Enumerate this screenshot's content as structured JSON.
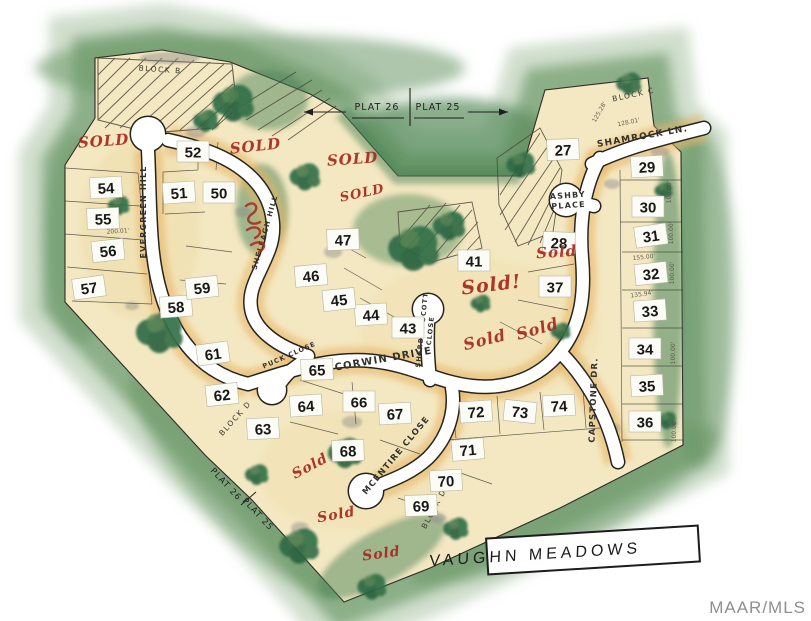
{
  "title_box": {
    "label": "VAUGHN  MEADOWS"
  },
  "watermark": "MAAR/MLS",
  "plat_notes": {
    "top_left": "PLAT 26",
    "top_right": "PLAT 25",
    "bottom_upper": "PLAT 26",
    "bottom_lower": "PLAT 25"
  },
  "blocks": [
    {
      "label": "BLOCK  B",
      "x": 160,
      "y": 72,
      "rotate": 4
    },
    {
      "label": "BLOCK  C",
      "x": 634,
      "y": 97,
      "rotate": -12
    },
    {
      "label": "BLOCK  D",
      "x": 237,
      "y": 420,
      "rotate": -48
    },
    {
      "label": "BLOCK  D",
      "x": 436,
      "y": 510,
      "rotate": -62
    }
  ],
  "streets": [
    {
      "name": "evergreen-hill",
      "lines": [
        "EVERGREEN  HILL"
      ],
      "x": 146,
      "y": 212,
      "rotate": -90,
      "size": 8
    },
    {
      "name": "sheleagh-hill",
      "lines": [
        "SHELEAGH  HILL"
      ],
      "x": 267,
      "y": 233,
      "rotate": -74,
      "size": 7
    },
    {
      "name": "shamrock-lane",
      "lines": [
        "SHAMROCK  LN."
      ],
      "x": 643,
      "y": 139,
      "rotate": -10,
      "size": 9
    },
    {
      "name": "ashby-place",
      "lines": [
        "ASHBY",
        "PLACE"
      ],
      "x": 568,
      "y": 198,
      "rotate": -4,
      "size": 8
    },
    {
      "name": "corwin-drive",
      "lines": [
        "CORWIN    DRIVE"
      ],
      "x": 384,
      "y": 362,
      "rotate": -10,
      "size": 10
    },
    {
      "name": "sherber-scott-close",
      "lines": [
        "SHERBER SCOTT",
        "CLOSE"
      ],
      "x": 424,
      "y": 330,
      "rotate": -84,
      "size": 6.5
    },
    {
      "name": "puck-close",
      "lines": [
        "PUCK  CLOSE"
      ],
      "x": 290,
      "y": 357,
      "rotate": -24,
      "size": 6.5
    },
    {
      "name": "mcentire-close",
      "lines": [
        "MCENTIRE  CLOSE"
      ],
      "x": 398,
      "y": 457,
      "rotate": -50,
      "size": 8.5
    },
    {
      "name": "capstone-drive",
      "lines": [
        "CAPSTONE  DR."
      ],
      "x": 596,
      "y": 400,
      "rotate": -88,
      "size": 8.5
    }
  ],
  "lots": [
    {
      "n": "27",
      "x": 563,
      "y": 150,
      "r": -2
    },
    {
      "n": "28",
      "x": 559,
      "y": 243,
      "r": 2
    },
    {
      "n": "29",
      "x": 647,
      "y": 167,
      "r": -3
    },
    {
      "n": "30",
      "x": 648,
      "y": 207,
      "r": 0
    },
    {
      "n": "31",
      "x": 651,
      "y": 236,
      "r": -8
    },
    {
      "n": "32",
      "x": 651,
      "y": 274,
      "r": -6
    },
    {
      "n": "33",
      "x": 650,
      "y": 311,
      "r": -4
    },
    {
      "n": "34",
      "x": 645,
      "y": 349,
      "r": 0
    },
    {
      "n": "35",
      "x": 647,
      "y": 386,
      "r": -3
    },
    {
      "n": "36",
      "x": 645,
      "y": 422,
      "r": 0
    },
    {
      "n": "37",
      "x": 555,
      "y": 287,
      "r": 0
    },
    {
      "n": "41",
      "x": 474,
      "y": 261,
      "r": 0
    },
    {
      "n": "43",
      "x": 408,
      "y": 328,
      "r": 0
    },
    {
      "n": "44",
      "x": 371,
      "y": 315,
      "r": -4
    },
    {
      "n": "45",
      "x": 339,
      "y": 300,
      "r": -6
    },
    {
      "n": "46",
      "x": 311,
      "y": 276,
      "r": -5
    },
    {
      "n": "47",
      "x": 343,
      "y": 240,
      "r": -2
    },
    {
      "n": "50",
      "x": 219,
      "y": 193,
      "r": 0
    },
    {
      "n": "51",
      "x": 179,
      "y": 193,
      "r": -4
    },
    {
      "n": "52",
      "x": 193,
      "y": 152,
      "r": 0
    },
    {
      "n": "54",
      "x": 106,
      "y": 188,
      "r": -3
    },
    {
      "n": "55",
      "x": 103,
      "y": 219,
      "r": -2
    },
    {
      "n": "56",
      "x": 108,
      "y": 251,
      "r": -6
    },
    {
      "n": "57",
      "x": 89,
      "y": 288,
      "r": -8
    },
    {
      "n": "58",
      "x": 176,
      "y": 307,
      "r": -4
    },
    {
      "n": "59",
      "x": 202,
      "y": 288,
      "r": -6
    },
    {
      "n": "61",
      "x": 213,
      "y": 354,
      "r": -8
    },
    {
      "n": "62",
      "x": 222,
      "y": 395,
      "r": -6
    },
    {
      "n": "63",
      "x": 263,
      "y": 429,
      "r": -3
    },
    {
      "n": "64",
      "x": 306,
      "y": 406,
      "r": -4
    },
    {
      "n": "65",
      "x": 317,
      "y": 370,
      "r": -2
    },
    {
      "n": "66",
      "x": 359,
      "y": 402,
      "r": 0
    },
    {
      "n": "67",
      "x": 395,
      "y": 414,
      "r": -3
    },
    {
      "n": "68",
      "x": 348,
      "y": 451,
      "r": -2
    },
    {
      "n": "69",
      "x": 421,
      "y": 506,
      "r": -2
    },
    {
      "n": "70",
      "x": 446,
      "y": 481,
      "r": -3
    },
    {
      "n": "71",
      "x": 468,
      "y": 450,
      "r": -5
    },
    {
      "n": "72",
      "x": 476,
      "y": 412,
      "r": -4
    },
    {
      "n": "73",
      "x": 520,
      "y": 412,
      "r": 6
    },
    {
      "n": "74",
      "x": 559,
      "y": 406,
      "r": -3
    }
  ],
  "sold_annotations": [
    {
      "text": "SOLD",
      "x": 104,
      "y": 146,
      "rotate": -4,
      "size": 15
    },
    {
      "text": "SOLD",
      "x": 256,
      "y": 151,
      "rotate": -6,
      "size": 15
    },
    {
      "text": "SOLD",
      "x": 353,
      "y": 164,
      "rotate": -4,
      "size": 15
    },
    {
      "text": "SOLD",
      "x": 363,
      "y": 197,
      "rotate": -12,
      "size": 13
    },
    {
      "text": "Sold!",
      "x": 492,
      "y": 291,
      "rotate": -7,
      "size": 19
    },
    {
      "text": "Sold",
      "x": 557,
      "y": 257,
      "rotate": -4,
      "size": 15
    },
    {
      "text": "Sold",
      "x": 486,
      "y": 345,
      "rotate": -14,
      "size": 16
    },
    {
      "text": "Sold",
      "x": 539,
      "y": 334,
      "rotate": -16,
      "size": 16
    },
    {
      "text": "Sold",
      "x": 312,
      "y": 470,
      "rotate": -28,
      "size": 14
    },
    {
      "text": "Sold",
      "x": 337,
      "y": 519,
      "rotate": -10,
      "size": 14
    },
    {
      "text": "Sold",
      "x": 382,
      "y": 558,
      "rotate": -8,
      "size": 14
    }
  ],
  "dimensions": [
    {
      "text": "100.00'",
      "x": 671,
      "y": 192,
      "rotate": -90
    },
    {
      "text": "100.00'",
      "x": 673,
      "y": 233,
      "rotate": -90
    },
    {
      "text": "100.00'",
      "x": 674,
      "y": 273,
      "rotate": -90
    },
    {
      "text": "100.00'",
      "x": 675,
      "y": 353,
      "rotate": -90
    },
    {
      "text": "100.00'",
      "x": 676,
      "y": 431,
      "rotate": -90
    },
    {
      "text": "155.00'",
      "x": 644,
      "y": 259,
      "rotate": -6
    },
    {
      "text": "135.94'",
      "x": 642,
      "y": 296,
      "rotate": -8
    },
    {
      "text": "125.28'",
      "x": 601,
      "y": 113,
      "rotate": -60
    },
    {
      "text": "128.01'",
      "x": 629,
      "y": 124,
      "rotate": -12
    },
    {
      "text": "200.01'",
      "x": 118,
      "y": 233,
      "rotate": -4
    }
  ],
  "colors": {
    "map_green": "#4a8457",
    "lot_cream": "#f4e8c2",
    "road_white": "#ffffff",
    "sold_red": "#a8281f",
    "ink": "#2b2b2b",
    "watermark_gray": "#8f8f8f",
    "halo_orange": "#e7b260"
  }
}
